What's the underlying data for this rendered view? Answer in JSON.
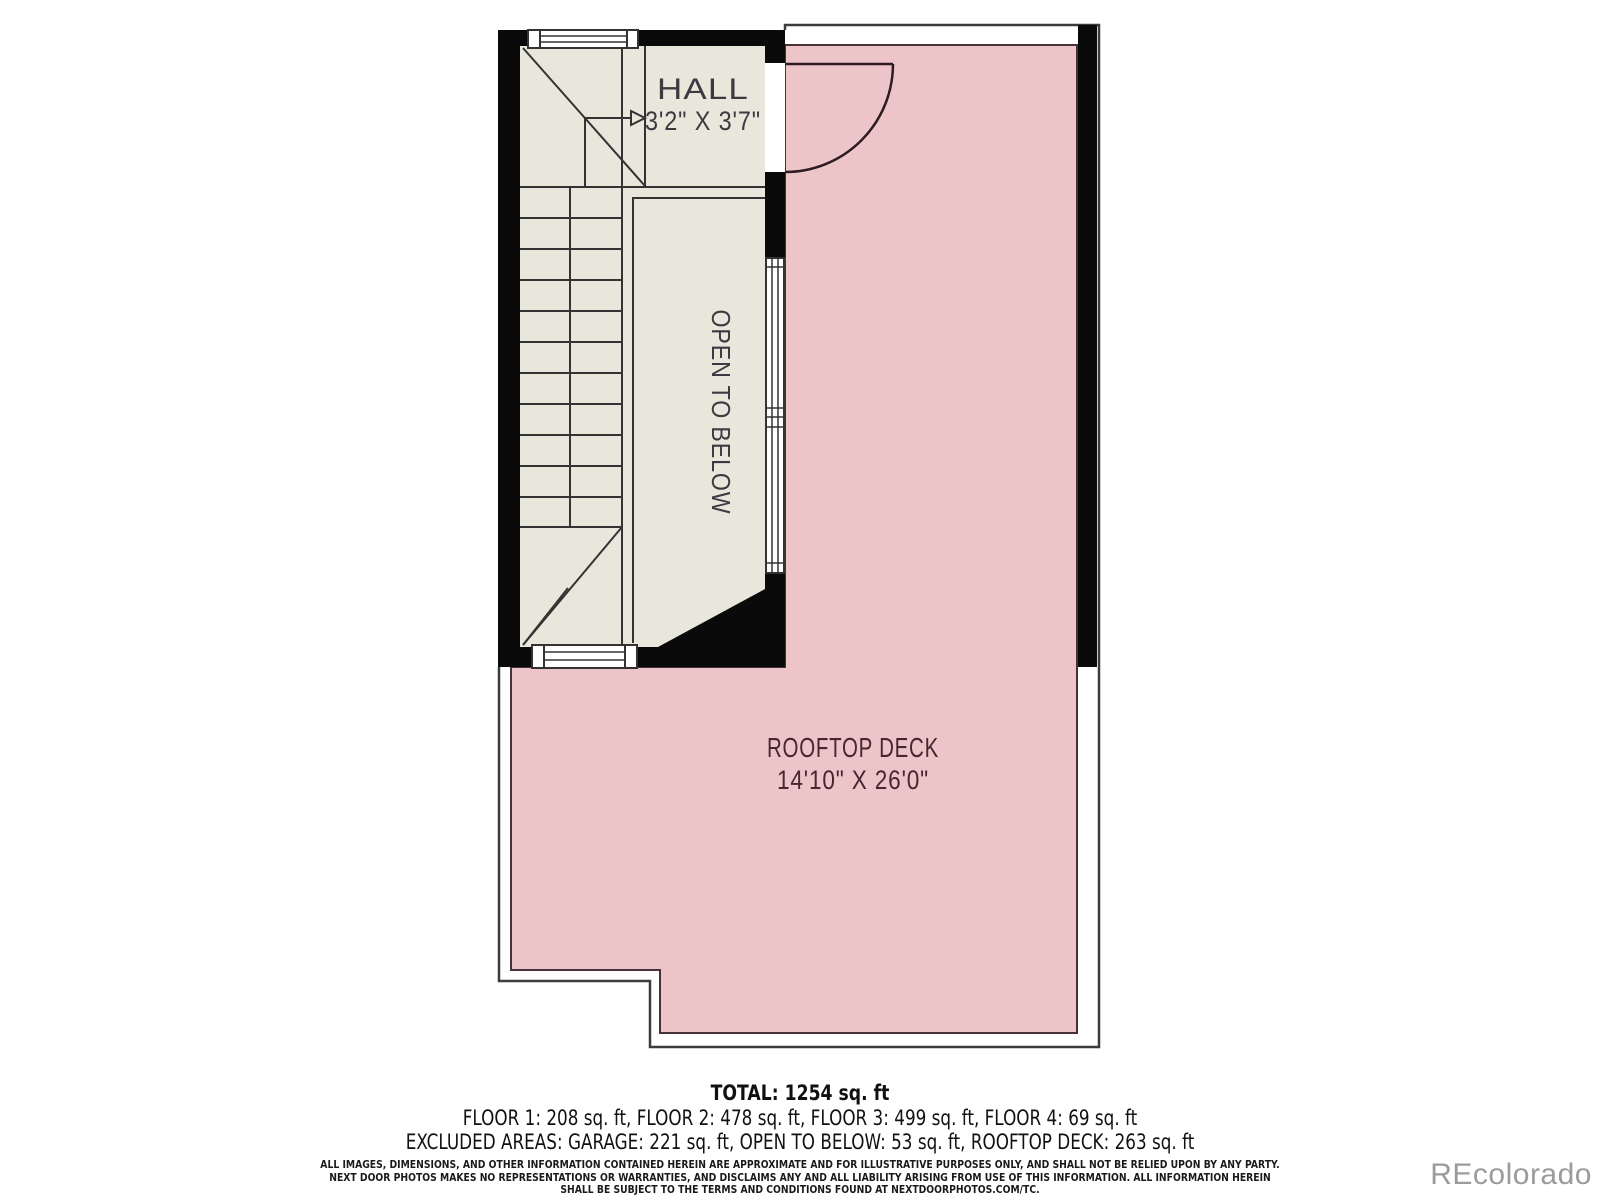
{
  "plan": {
    "rooms": {
      "hall": {
        "label": "HALL",
        "dims": "3'2\" X 3'7\""
      },
      "open_to_below": {
        "label": "OPEN TO BELOW"
      },
      "rooftop_deck": {
        "label": "ROOFTOP DECK",
        "dims": "14'10\" X 26'0\""
      }
    },
    "colors": {
      "deck_fill": "#edc5c9",
      "floor_fill": "#e9e7dc",
      "wall": "#0a0a0a",
      "line": "#333333",
      "room_label": "#3a3a40",
      "deck_label": "#46262f",
      "watermark": "#9b9b9b"
    }
  },
  "summary": {
    "total": "TOTAL: 1254 sq. ft",
    "floors": "FLOOR 1: 208 sq. ft, FLOOR 2: 478 sq. ft, FLOOR 3: 499 sq. ft, FLOOR 4: 69 sq. ft",
    "excluded": "EXCLUDED AREAS: GARAGE: 221 sq. ft, OPEN TO BELOW: 53 sq. ft, ROOFTOP DECK: 263 sq. ft"
  },
  "disclaimer": {
    "line1": "ALL IMAGES, DIMENSIONS, AND OTHER INFORMATION CONTAINED HEREIN ARE APPROXIMATE AND FOR ILLUSTRATIVE PURPOSES ONLY, AND SHALL NOT BE RELIED UPON BY ANY PARTY.",
    "line2": "NEXT DOOR PHOTOS MAKES NO REPRESENTATIONS OR WARRANTIES, AND DISCLAIMS ANY AND ALL LIABILITY ARISING FROM USE OF THIS INFORMATION. ALL INFORMATION HEREIN",
    "line3": "SHALL BE SUBJECT TO THE TERMS AND CONDITIONS FOUND AT NEXTDOORPHOTOS.COM/TC."
  },
  "watermark": "REcolorado"
}
